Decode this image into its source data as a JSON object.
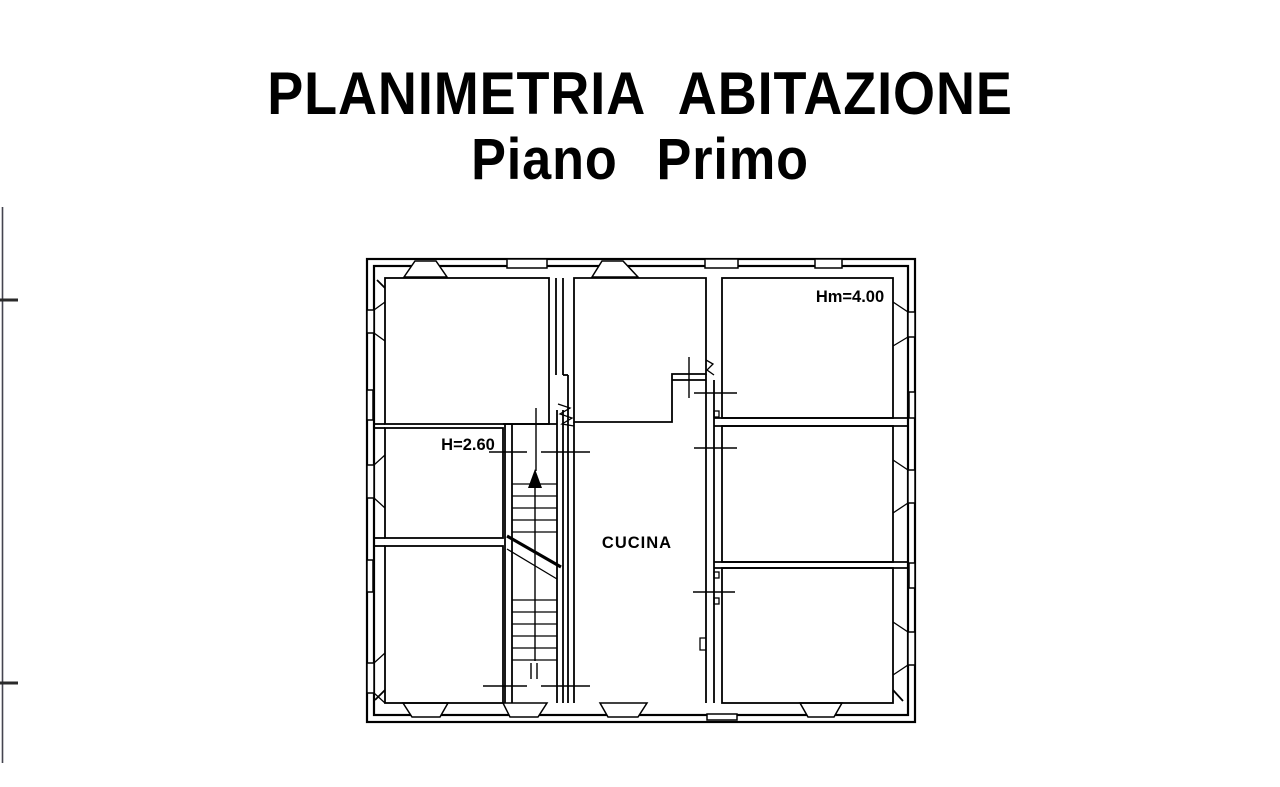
{
  "canvas": {
    "width": 1280,
    "height": 787,
    "background_color": "#ffffff",
    "ink_color": "#000000",
    "edge_artifact_color": "#44444f"
  },
  "title": {
    "line1": "PLANIMETRIA ABITAZIONE",
    "line2": "Piano Primo"
  },
  "plan": {
    "type": "residential-floor-plan",
    "annotations": {
      "height_main": "Hm=4.00",
      "height_stair": "H=2.60",
      "kitchen": "CUCINA"
    }
  }
}
